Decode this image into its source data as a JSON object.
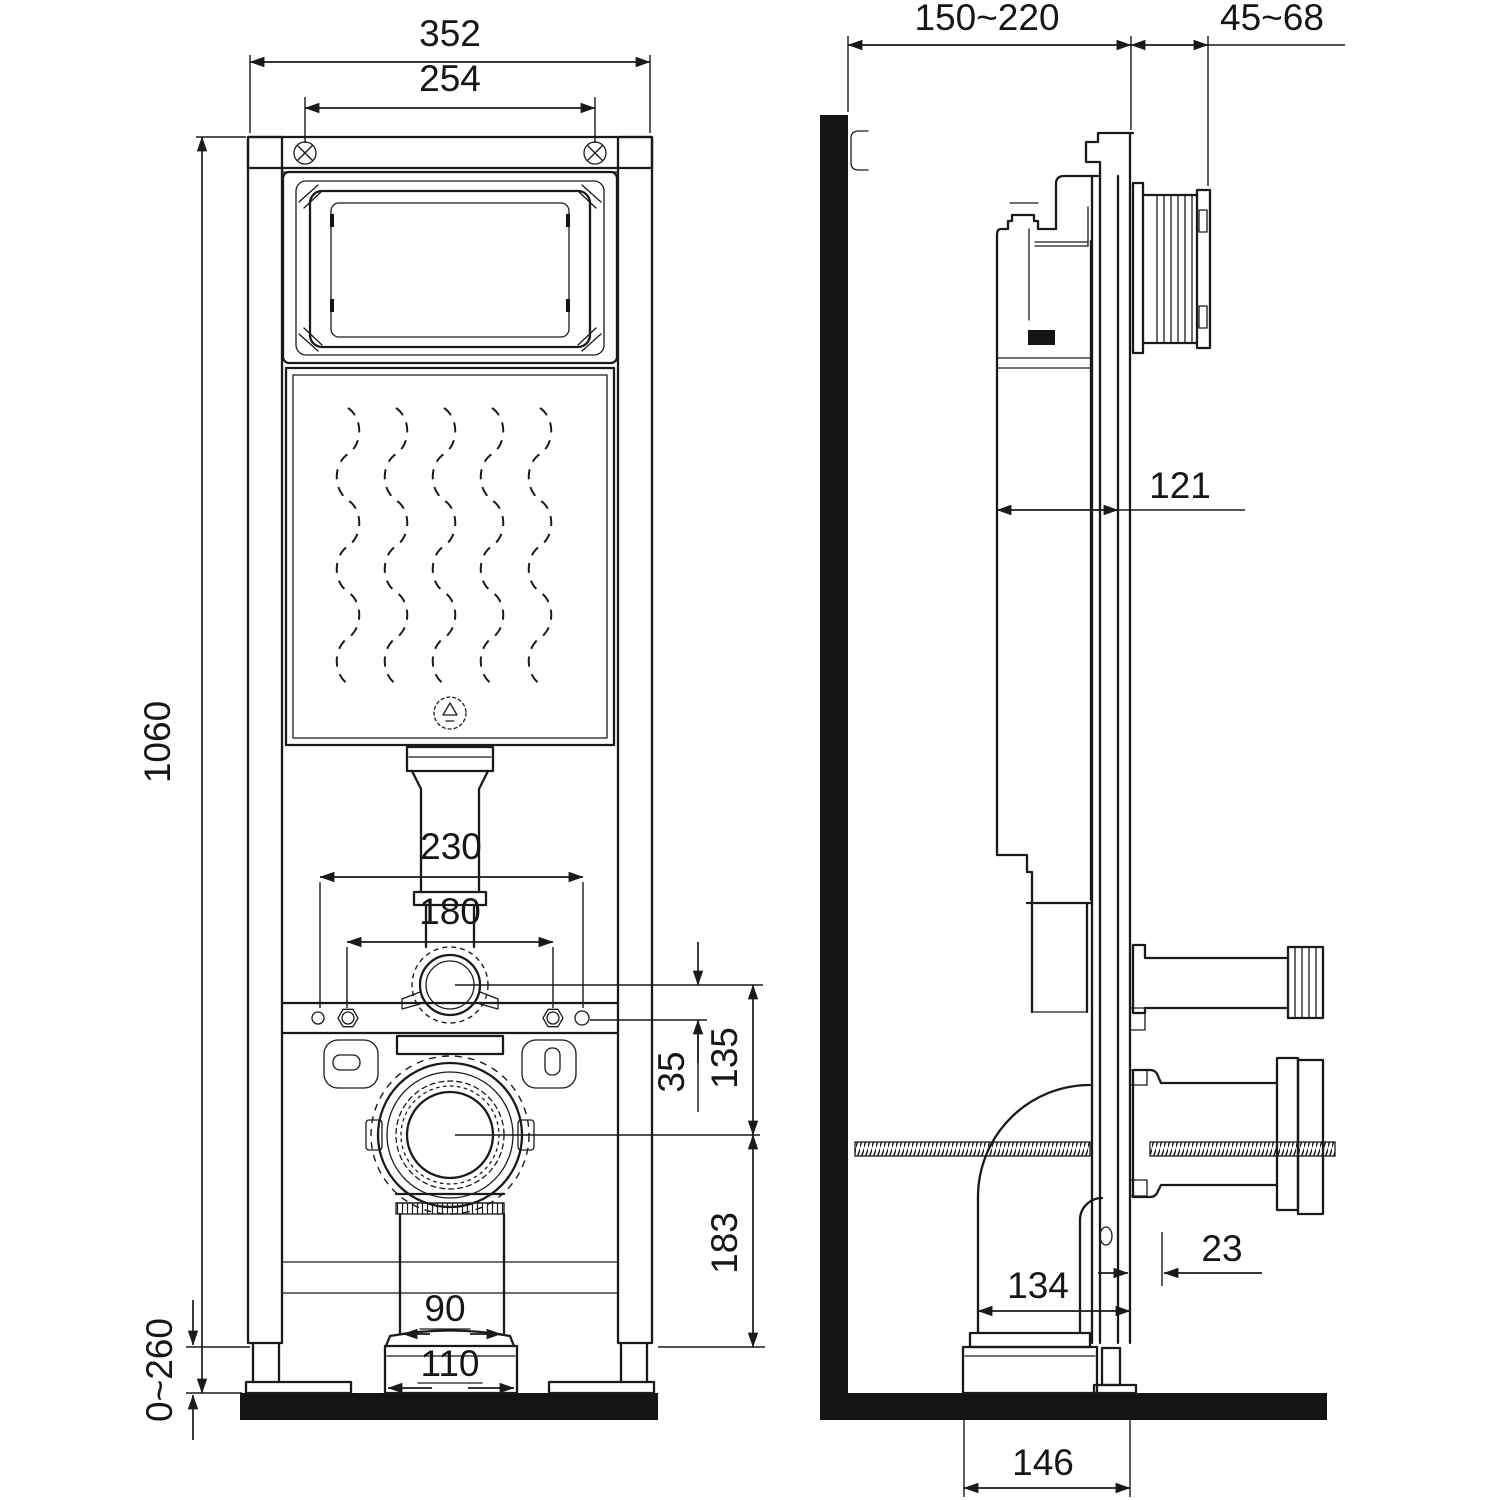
{
  "drawing": {
    "kind": "concealed WC installation frame - dimensioned technical drawing",
    "views": {
      "front_label": "front view",
      "side_label": "side view"
    },
    "dims": {
      "front": {
        "total_width": "352",
        "mount_spacing": "254",
        "height": "1060",
        "fix_outer": "230",
        "fix_inner": "180",
        "inlet_drop": "35",
        "inlet_outlet": "135",
        "outlet_height": "183",
        "outlet_pipe": "90",
        "outlet_socket": "110",
        "foot_range": "0~260"
      },
      "side": {
        "wall_offset": "150~220",
        "panel_depth": "45~68",
        "body_depth": "121",
        "rear_gap": "23",
        "pipe_offset": "134",
        "floor_offset": "146"
      }
    }
  }
}
